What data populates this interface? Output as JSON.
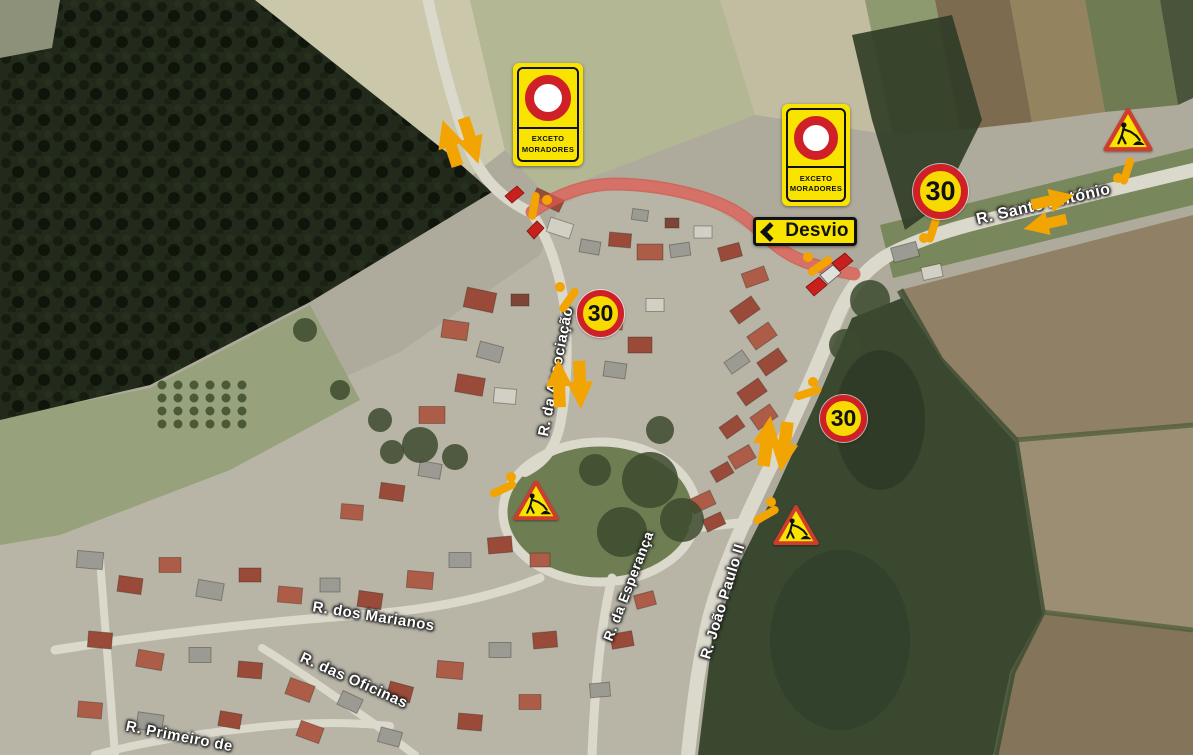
{
  "map": {
    "description": "Aerial satellite view of a village with a signed roadworks detour plan",
    "road_labels": [
      {
        "id": "santo-antonio",
        "text": "R. Santo António"
      },
      {
        "id": "associacao",
        "text": "R. da Associação"
      },
      {
        "id": "esperanca",
        "text": "R. da Esperança"
      },
      {
        "id": "joao-paulo-ii",
        "text": "R. João Paulo II"
      },
      {
        "id": "marianos",
        "text": "R. dos Marianos"
      },
      {
        "id": "oficinas",
        "text": "R. das Oficinas"
      },
      {
        "id": "primeiro",
        "text": "R. Primeiro de"
      }
    ]
  },
  "signs": {
    "no_entry": {
      "line1": "EXCETO",
      "line2": "MORADORES"
    },
    "detour": {
      "label": "Desvio",
      "direction": "left"
    },
    "speed": {
      "value": "30"
    }
  },
  "colors": {
    "sign_yellow": "#f9e400",
    "sign_red": "#cf2027",
    "arrow_orange": "#f2a402",
    "closed_route_red": "#d4574e"
  }
}
